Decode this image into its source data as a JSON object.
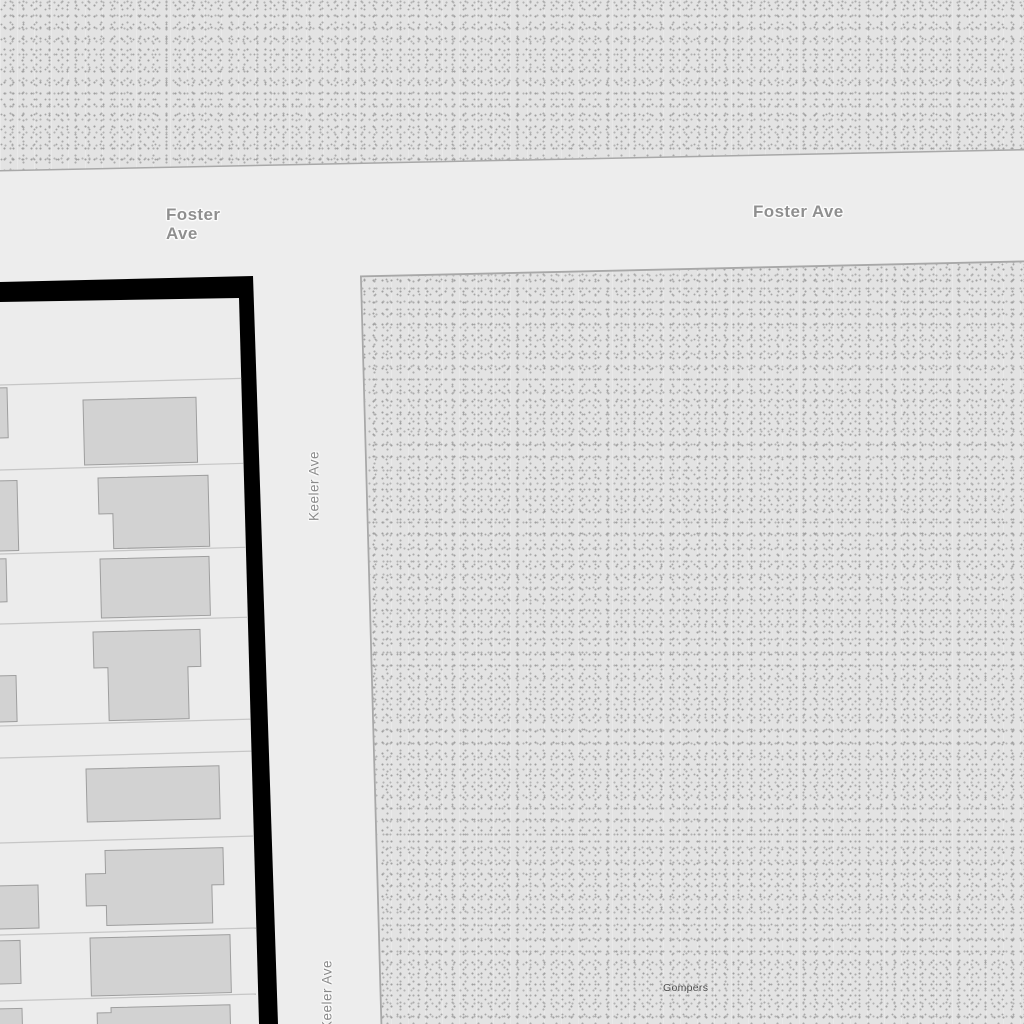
{
  "map": {
    "road_labels": {
      "foster_ave_west": "Foster Ave",
      "foster_ave_east": "Foster Ave",
      "keeler_ave_north": "Keeler Ave",
      "keeler_ave_south": "Keeler Ave"
    },
    "place_labels": {
      "gompers_park": "Gompers"
    },
    "colors": {
      "road_fill": "#ededed",
      "park_fill": "#e3e3e3",
      "park_stipple": "#a5a5a5",
      "park_outline": "#a8a8a8",
      "parcel_fill": "#ececec",
      "parcel_line": "#c6c6c6",
      "building_fill": "#d2d2d2",
      "building_outline": "#9e9e9e",
      "selected_block_outline": "#000000",
      "road_label_color": "#8f8f8f",
      "place_label_color": "#4a4a4a"
    }
  }
}
